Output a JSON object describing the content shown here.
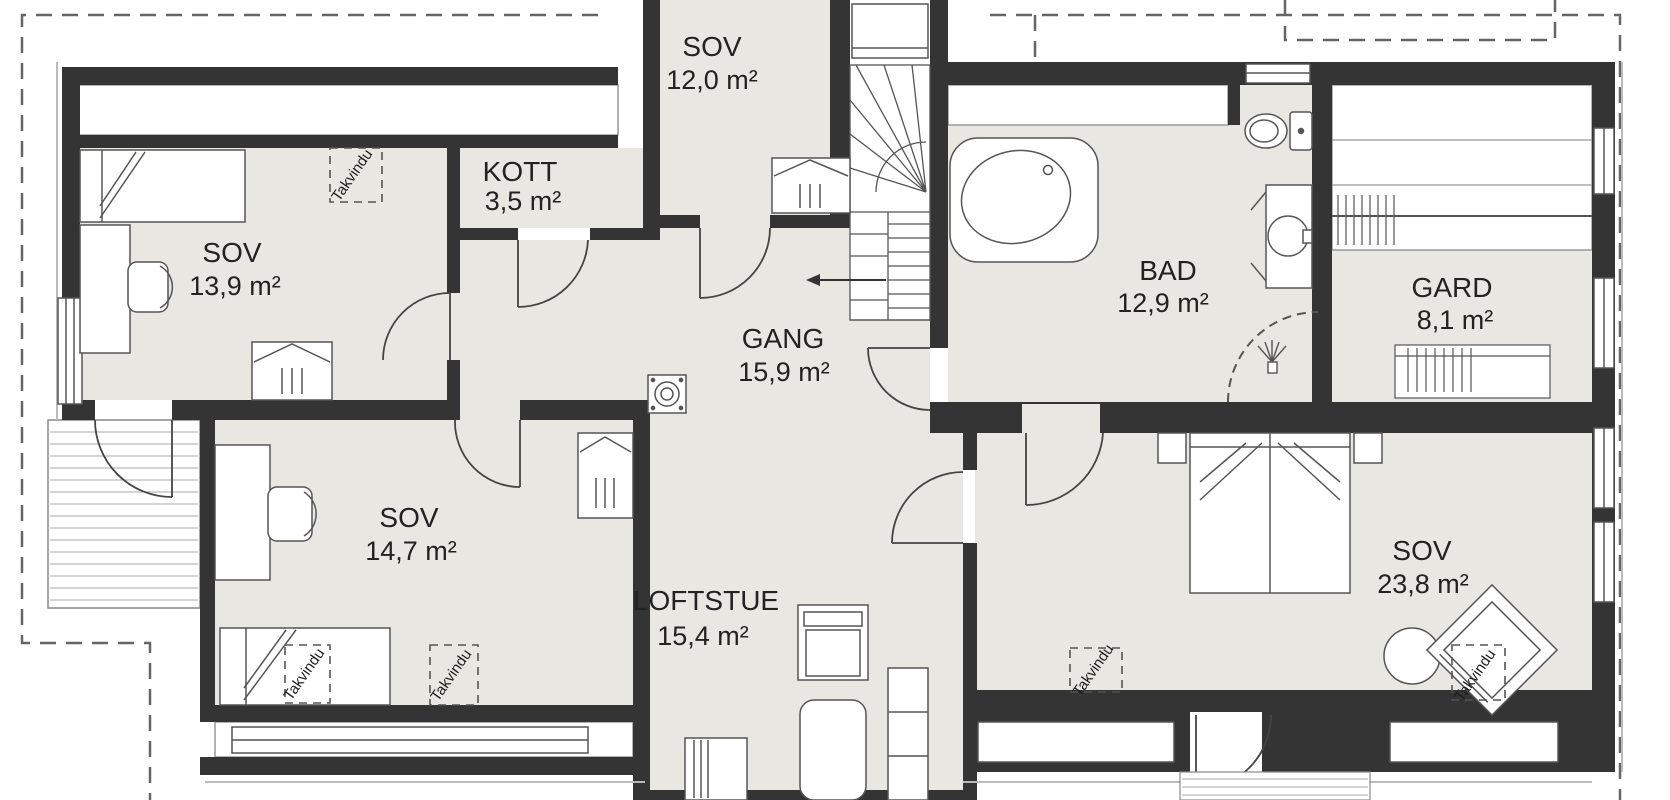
{
  "plan": {
    "type": "floor-plan",
    "language": "Norwegian",
    "rooms": [
      {
        "id": "sov-13-9",
        "name": "SOV",
        "area": "13,9 m²"
      },
      {
        "id": "kott",
        "name": "KOTT",
        "area": "3,5 m²"
      },
      {
        "id": "sov-12-0",
        "name": "SOV",
        "area": "12,0 m²"
      },
      {
        "id": "bad",
        "name": "BAD",
        "area": "12,9 m²"
      },
      {
        "id": "gard",
        "name": "GARD",
        "area": "8,1 m²"
      },
      {
        "id": "gang",
        "name": "GANG",
        "area": "15,9 m²"
      },
      {
        "id": "sov-14-7",
        "name": "SOV",
        "area": "14,7 m²"
      },
      {
        "id": "loftstue",
        "name": "LOFTSTUE",
        "area": "15,4 m²"
      },
      {
        "id": "sov-23-8",
        "name": "SOV",
        "area": "23,8 m²"
      }
    ],
    "labels": {
      "roof_window": "Takvindu"
    },
    "colors": {
      "wall": "#343434",
      "floor": "#e9e7e2",
      "outline": "#555555",
      "dashed_roof_line": "#666666",
      "background": "#ffffff"
    }
  }
}
